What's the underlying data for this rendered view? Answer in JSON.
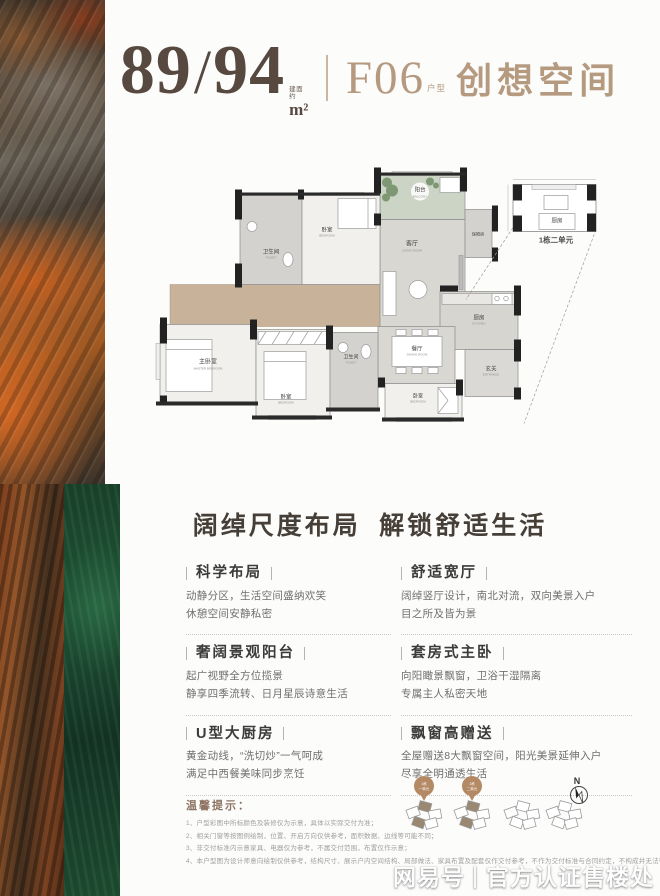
{
  "header": {
    "area_main": "89",
    "area_slash": "/",
    "area_secondary": "94",
    "area_note_l1": "建面",
    "area_note_l2": "约",
    "area_unit": "m²",
    "unit_code": "F06",
    "unit_code_suffix": "户型",
    "unit_name": "创想空间"
  },
  "floorplan": {
    "rooms": [
      {
        "cn": "阳台",
        "en": "BALCONY"
      },
      {
        "cn": "卧室",
        "en": "BEDROOM"
      },
      {
        "cn": "卫生间",
        "en": "TOILET"
      },
      {
        "cn": "客厅",
        "en": "LIVING ROOM"
      },
      {
        "cn": "保姆房",
        "en": ""
      },
      {
        "cn": "主卧室",
        "en": "MASTER BEDROOM"
      },
      {
        "cn": "卧室",
        "en": "BEDROOM"
      },
      {
        "cn": "卫生间",
        "en": "TOILET"
      },
      {
        "cn": "餐厅",
        "en": "DINING ROOM"
      },
      {
        "cn": "厨房",
        "en": "KITCHEN"
      },
      {
        "cn": "玄关",
        "en": "ENTRANCE"
      },
      {
        "cn": "卧室",
        "en": "BEDROOM"
      },
      {
        "cn": "厨房",
        "en": ""
      }
    ],
    "inset_caption": "1栋二单元"
  },
  "section": {
    "title": "阔绰尺度布局  解锁舒适生活"
  },
  "features": [
    {
      "title": "科学布局",
      "line1": "动静分区，生活空间盛纳欢笑",
      "line2": "休憩空间安静私密"
    },
    {
      "title": "舒适宽厅",
      "line1": "阔绰竖厅设计，南北对流，双向美景入户",
      "line2": "目之所及皆为景"
    },
    {
      "title": "奢阔景观阳台",
      "line1": "起广视野全方位揽景",
      "line2": "静享四季流转、日月星辰诗意生活"
    },
    {
      "title": "套房式主卧",
      "line1": "向阳瞰景飘窗，卫浴干湿隔离",
      "line2": "专属主人私密天地"
    },
    {
      "title": "U型大厨房",
      "line1": "黄金动线，“洗切炒”一气呵成",
      "line2": "满足中西餐美味同步烹饪"
    },
    {
      "title": "飘窗高赠送",
      "line1": "全屋赠送8大飘窗空间，阳光美景延伸入户",
      "line2": "尽享全明通透生活"
    }
  ],
  "tips": {
    "title": "温馨提示：",
    "lines": [
      "1、户型彩图中所标颜色及装修仅为示意，具体以实际交付为准；",
      "2、相关门窗等按图例绘制，位置、开启方向仅供参考，面积数据、边线等可能不同；",
      "3、非交付标准内示意家具、电器仅为参考，不属交付范围，布置仅作示意；",
      "4、本户型图为设计师意向绘制仅供参考，结构尺寸、展示户内空间结构、局部做法、家具布置及配套仅作交付参考，不作为交付标准与合同约定，不构成并无法律约束的任何要约与承诺，解释权归出卖人所有。"
    ]
  },
  "site": {
    "pins": [
      {
        "l1": "1栋",
        "l2": "一单元"
      },
      {
        "l1": "1栋",
        "l2": "二单元"
      }
    ],
    "compass_n": "N"
  },
  "watermark": {
    "brand": "网易号",
    "divider": "|",
    "text": "官方认证售楼处"
  },
  "colors": {
    "accent_tan": "#b59a80",
    "heading_dark": "#463f37",
    "tips_brown": "#8d7361",
    "texture_orange": "#a35a22",
    "texture_green": "#1e5435"
  }
}
